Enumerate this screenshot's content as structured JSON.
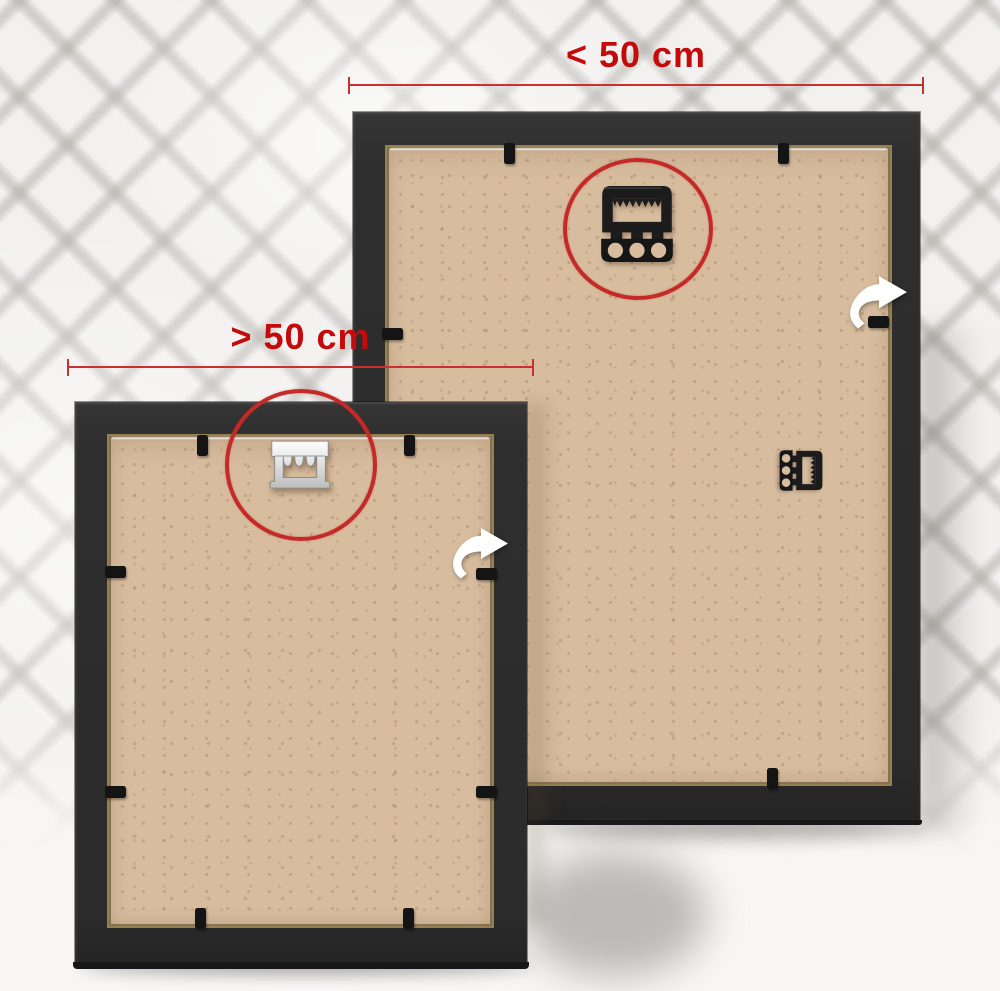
{
  "annotations": {
    "large_frame_label": "< 50 cm",
    "small_frame_label": "> 50 cm"
  },
  "colors": {
    "accent_red": "#c40a0a",
    "circle_red": "#c42a27",
    "frame_black": "#2e2e2e",
    "backboard_tan": "#d7bc9e",
    "hanger_plastic_black": "#1c1c1c",
    "hanger_metal_silver": "#e9e9e9",
    "wall_white": "#f2f1ef"
  },
  "icons": {
    "flip_arrow": "flip-arrow-icon",
    "black_hanger": "sawtooth-hanger-black-icon",
    "metal_hanger": "sawtooth-hanger-metal-icon",
    "spare_hanger": "spare-hanger-icon",
    "highlight_circle": "highlight-circle"
  }
}
